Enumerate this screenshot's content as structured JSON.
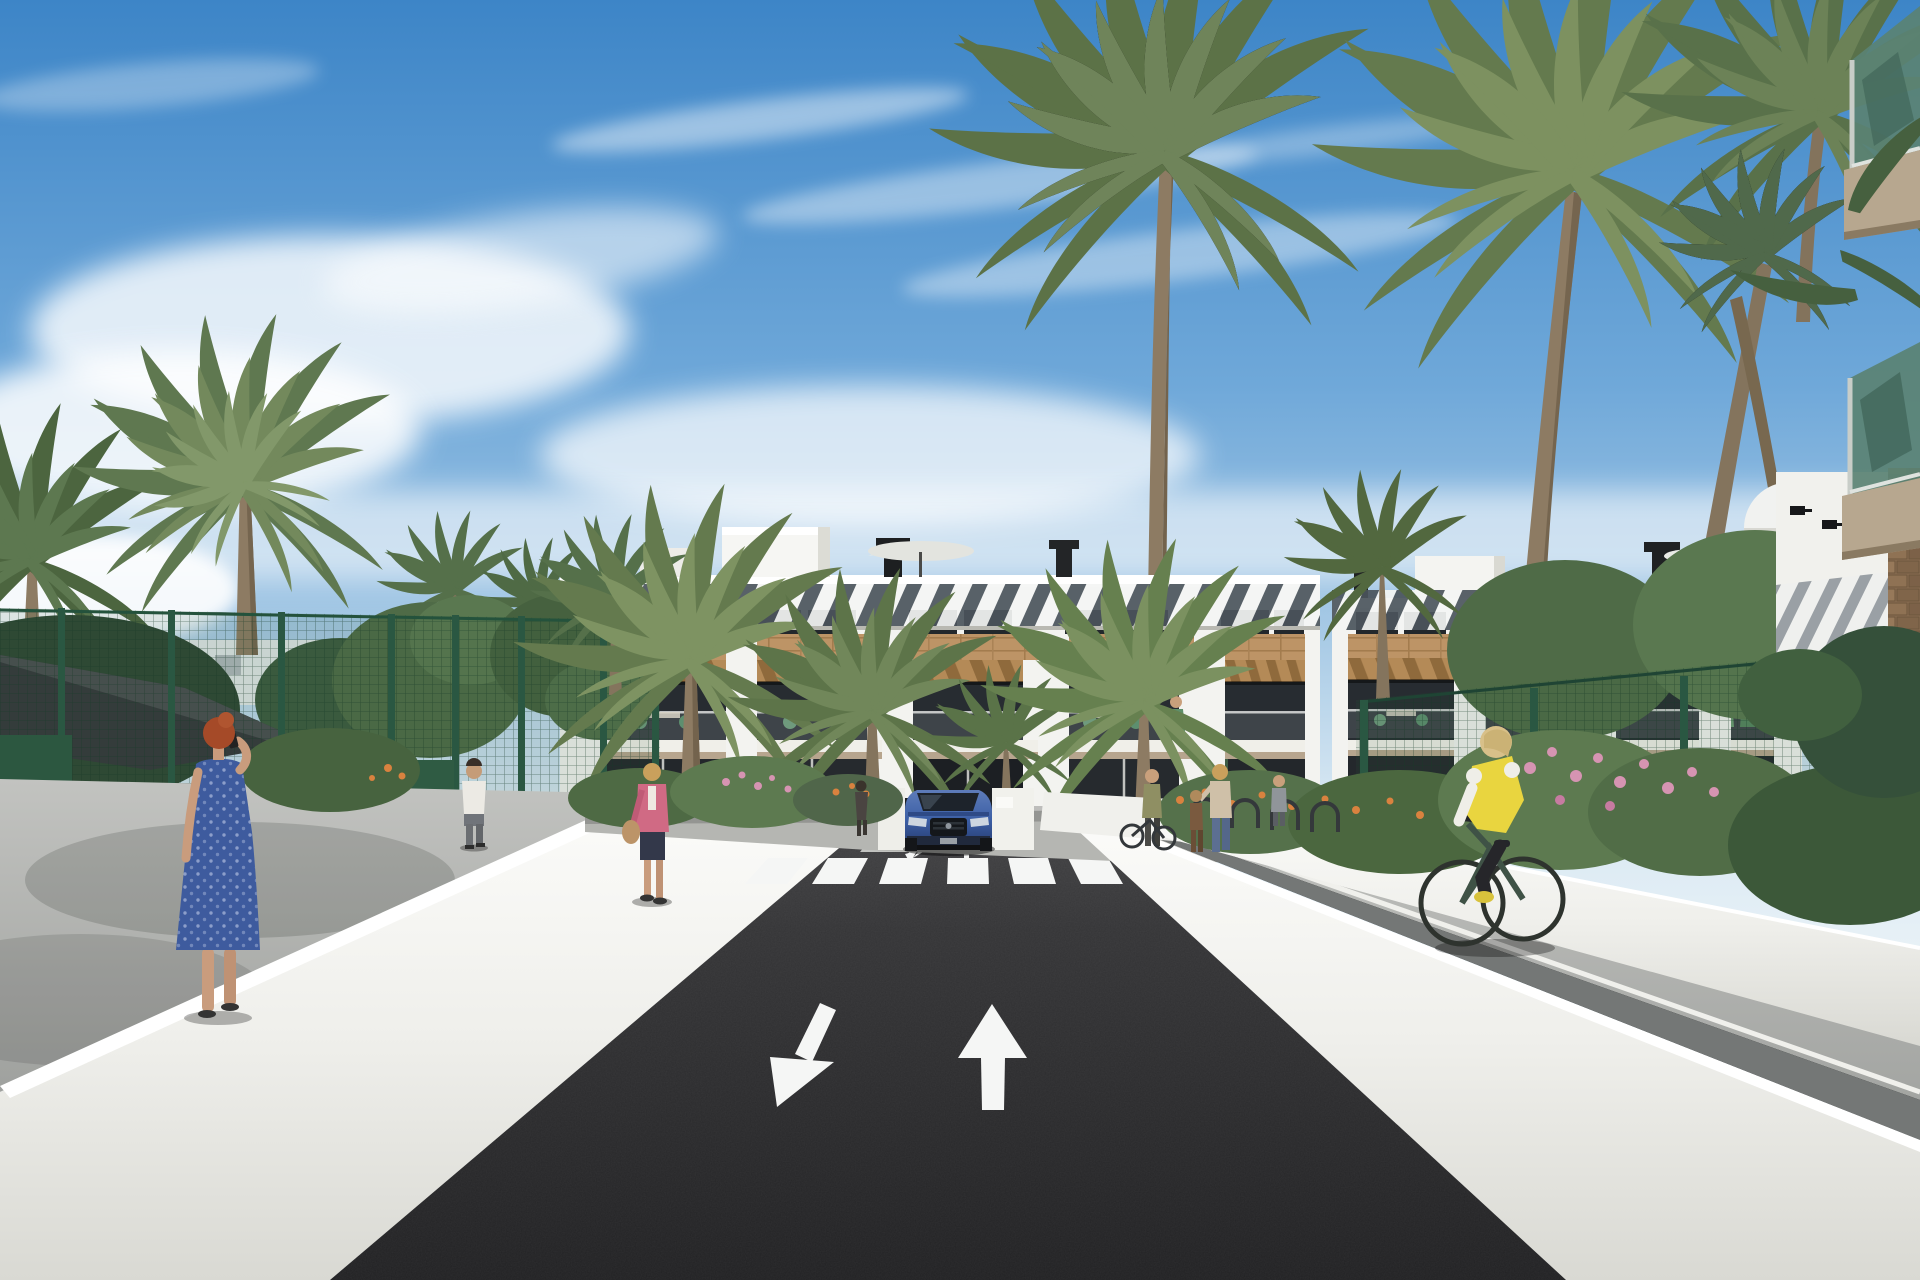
{
  "scene": {
    "description": "3D architectural rendering of a white Mediterranean apartment complex with wood-clad balconies and roof louvers, many palm trees, a dark asphalt access road with a zebra crossing and painted two-way lane arrows, a blue SUV at the garage ramp, pedestrians on the side walkways and a cyclist in a yellow vest, under a blue sky with wispy clouds.",
    "labels": {
      "sky": "Blue sky with wispy clouds",
      "building": "White apartment block with wooden pergola balconies and louvered roofline",
      "road": "Dark asphalt access road",
      "crosswalk": "White zebra crossing",
      "arrow_toward": "Lane arrow pointing toward viewer",
      "arrow_away": "Lane arrow pointing away from viewer",
      "car": "Blue SUV at the garage ramp entrance",
      "cyclist": "Cyclist in yellow vest on right walkway",
      "woman_blue_dress": "Red-haired woman in blue dress holding a phone",
      "man_white_shirt": "Man in white shirt walking on left path",
      "woman_pink_jacket": "Woman in pink jacket with handbag",
      "shade_sail": "Dark shade sail over the sports court",
      "fence": "Green mesh court fencing",
      "palms": "Palm trees",
      "trees": "Leafy trees",
      "foreground_balconies": "Foreground building corner with green glass balconies",
      "water_tank": "White spherical rooftop tank",
      "roof_parasol": "White parasol on roof terrace",
      "bike_racks": "Bicycle stands by the entrance",
      "flowers": "Flowering shrubs in planters",
      "left_wall": "White retaining wall left of road",
      "right_wall": "White retaining wall right of road",
      "forecourt": "Paved forecourt in front of building"
    },
    "people_count": 10
  },
  "palette": {
    "sky_top": "#3d85c7",
    "sky_horizon": "#e9f2f7",
    "building_white": "#f3f3f0",
    "wood_clad": "#bd9466",
    "pergola_wood": "#a47d4c",
    "glass_dark": "#272c31",
    "slab_tan": "#b7a58e",
    "asphalt": "#2a2a2c",
    "marking_white": "#f5f6f5",
    "wall_white": "#efefec",
    "path_grey": "#a7a9a8",
    "fence_green": "#2f5b43",
    "palm_green": "#6a7f55",
    "palm_light": "#8a9c6e",
    "trunk_brown": "#8d7b63",
    "leaf_dark": "#46603f",
    "flower_pink": "#d694b2",
    "flower_orange": "#d9823f",
    "car_blue": "#3c5fa5",
    "vest_yellow": "#e9d53f",
    "dress_blue": "#3e5b9e",
    "hair_red": "#a54a28",
    "jacket_pink": "#d06a84",
    "sail_dark": "#35383b",
    "balcony_glass_green": "#5a8273",
    "stone_brown": "#8a6f52"
  }
}
